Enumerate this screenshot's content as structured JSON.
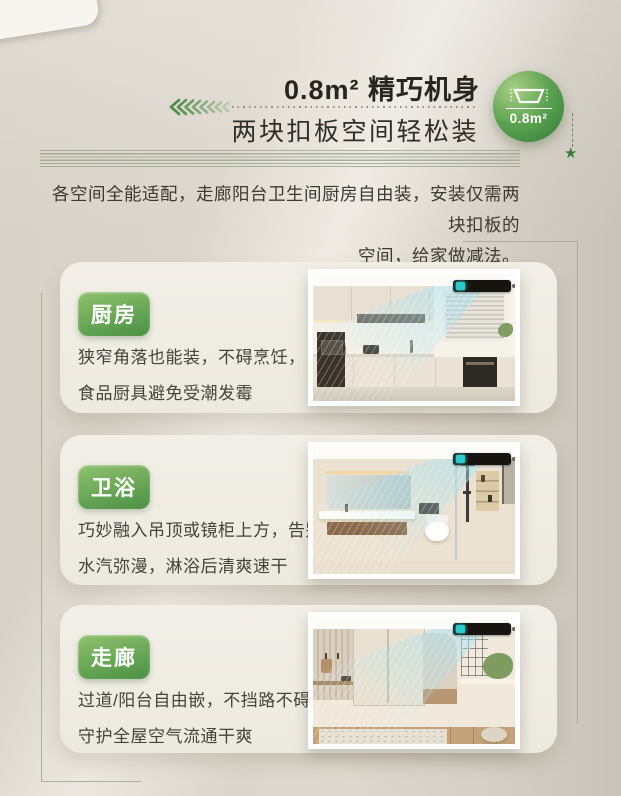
{
  "header": {
    "title": "0.8m² 精巧机身",
    "subtitle": "两块扣板空间轻松装",
    "circle_badge": {
      "label": "0.8m²",
      "icon": "recessed-unit-icon"
    },
    "star": "★"
  },
  "intro": {
    "line1": "各空间全能适配，走廊阳台卫生间厨房自由装，安装仅需两块扣板的",
    "line2": "空间，给家做减法。"
  },
  "cards": [
    {
      "tag": "厨房",
      "desc_line1": "狭窄角落也能装，不碍烹饪，",
      "desc_line2": "食品厨具避免受潮发霉",
      "photo": "kitchen"
    },
    {
      "tag": "卫浴",
      "desc_line1": "巧妙融入吊顶或镜柜上方，告别",
      "desc_line2": "水汽弥漫，淋浴后清爽速干",
      "photo": "bathroom"
    },
    {
      "tag": "走廊",
      "desc_line1": "过道/阳台自由嵌，不挡路不碍眼，",
      "desc_line2": "守护全屋空气流通干爽",
      "photo": "corridor"
    }
  ],
  "colors": {
    "badge_green": "#4a9144",
    "badge_green_light": "#8fc16d",
    "circle_green": "#2e7c37",
    "text_dark": "#26251f",
    "airflow_blue": "#9ee0f2",
    "background_beige": "#d8d2c8"
  }
}
